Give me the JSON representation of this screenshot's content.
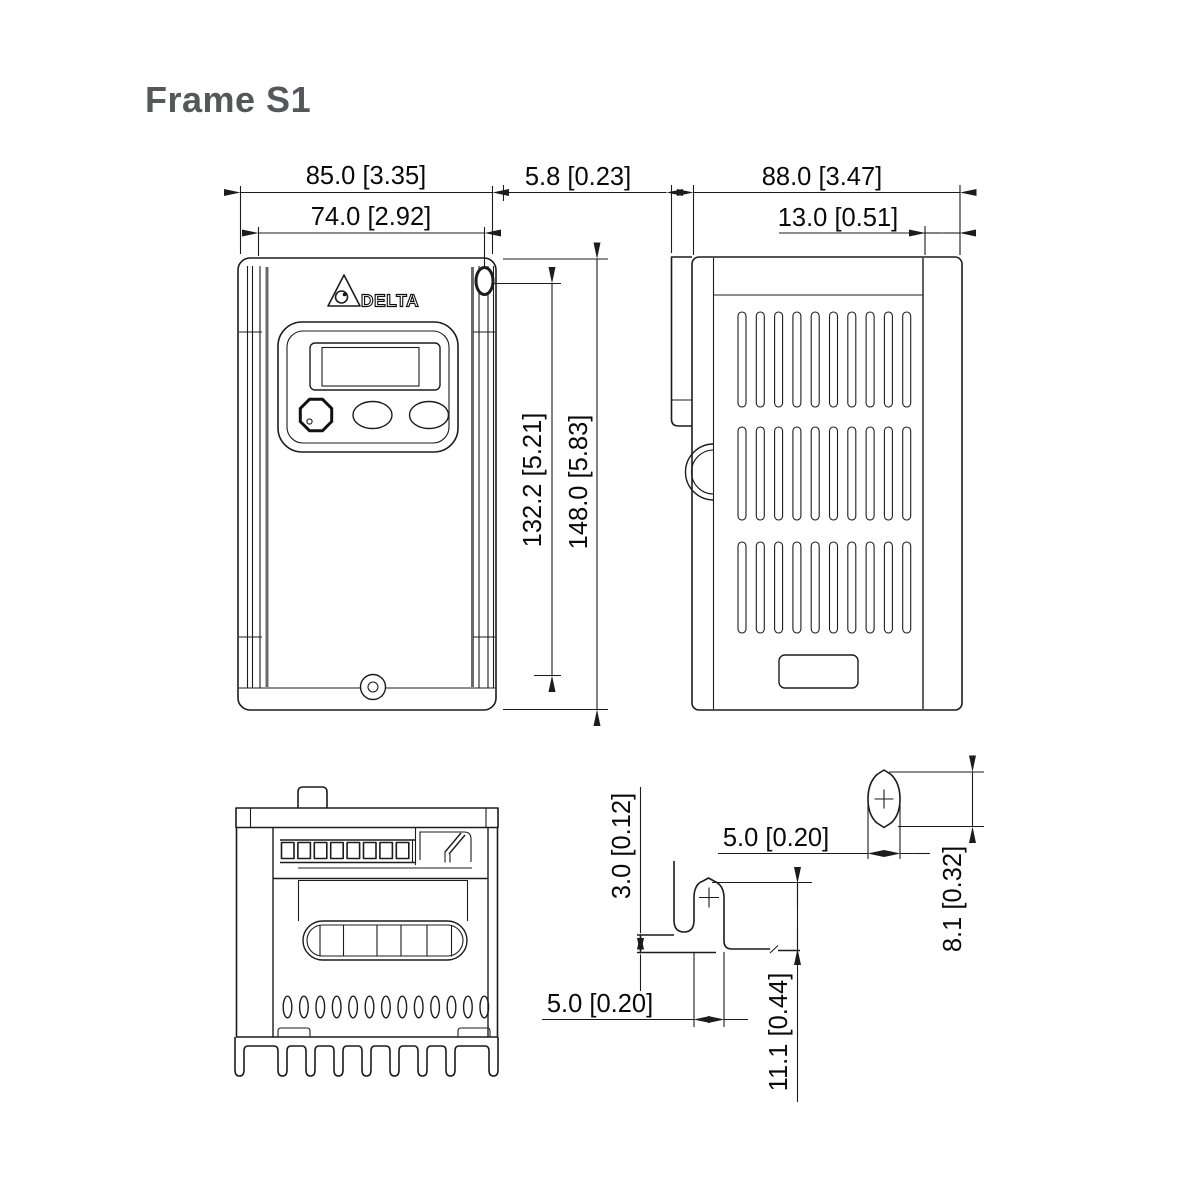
{
  "title": "Frame S1",
  "logo": {
    "brand": "DELTA"
  },
  "colors": {
    "line": "#1c1c1c",
    "title_text": "#56575b",
    "dim_text": "#0a0a0a",
    "background": "#ffffff"
  },
  "front_view": {
    "dims": {
      "width_overall": "85.0 [3.35]",
      "width_mounting": "74.0 [2.92]",
      "height_mounting": "132.2 [5.21]",
      "height_overall": "148.0 [5.83]"
    }
  },
  "side_view": {
    "dims": {
      "front_lip_depth": "5.8 [0.23]",
      "depth_overall": "88.0 [3.47]",
      "rear_section_depth": "13.0 [0.51]"
    }
  },
  "mounting_details": {
    "lower_slot": {
      "tab_step": "3.0 [0.12]",
      "slot_width": "5.0 [0.20]",
      "slot_height": "11.1 [0.44]"
    },
    "upper_hole": {
      "hole_width": "5.0 [0.20]",
      "hole_height": "8.1 [0.32]"
    }
  }
}
